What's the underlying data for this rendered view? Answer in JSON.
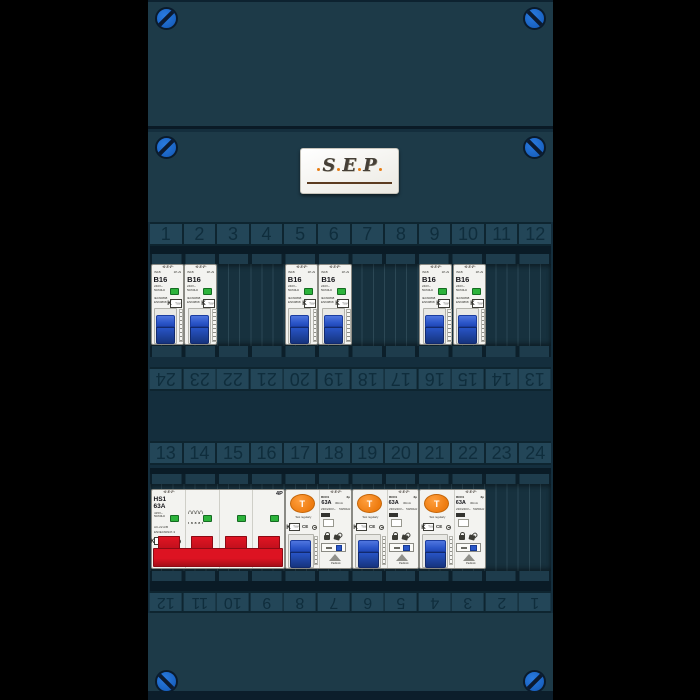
{
  "brand_logo": {
    "letters": [
      "S",
      "E",
      "P"
    ]
  },
  "strips": {
    "top": [
      "1",
      "2",
      "3",
      "4",
      "5",
      "6",
      "7",
      "8",
      "9",
      "10",
      "11",
      "12"
    ],
    "upper_inverted": [
      "24",
      "23",
      "22",
      "21",
      "20",
      "19",
      "18",
      "17",
      "16",
      "15",
      "14",
      "13"
    ],
    "lower": [
      "13",
      "14",
      "15",
      "16",
      "17",
      "18",
      "19",
      "20",
      "21",
      "22",
      "23",
      "24"
    ],
    "bottom_inverted": [
      "12",
      "11",
      "10",
      "9",
      "8",
      "7",
      "6",
      "5",
      "4",
      "3",
      "2",
      "1"
    ]
  },
  "devices": {
    "mcb": {
      "brand": "·S·E·P·",
      "model": "IN1B",
      "poles": "1P+N",
      "rating": "B16",
      "voltage": "240V~",
      "frequency": "50/60Hz",
      "standard1": "IEC60898",
      "standard2": "EN60898",
      "cert_mark": "K",
      "cert_sub": "TUV"
    },
    "main_switch": {
      "brand": "·S·E·P·",
      "model": "HS1",
      "rating": "63A",
      "voltage": "415V~",
      "frequency": "50/60Hz",
      "utilization": "AC-22 A/B",
      "standard": "EN/IEC60947-3",
      "cert_mark": "K",
      "cert_sub": "TUV",
      "ce_mark": "CE",
      "poles_label": "4P"
    },
    "rcd": {
      "brand": "·S·E·P·",
      "test_button": "T",
      "test_note": "Test regularly",
      "model": "RCD1",
      "poles": "2p",
      "rating": "63A",
      "sensitivity": "30mA",
      "voltage": "230/240V~",
      "frequency": "50/60Hz",
      "cert_mark": "K",
      "cert_sub": "TUV",
      "ce_mark": "CE",
      "padlock_label": "Padlock"
    }
  },
  "colors": {
    "cabinet": "#1d3a48",
    "screw_blue": "#1766c8",
    "mcb_handle_blue": "#2450bf",
    "main_handle_red": "#cf1120",
    "rcd_test_orange": "#ee7c10",
    "indicator_green": "#2cb33b"
  }
}
